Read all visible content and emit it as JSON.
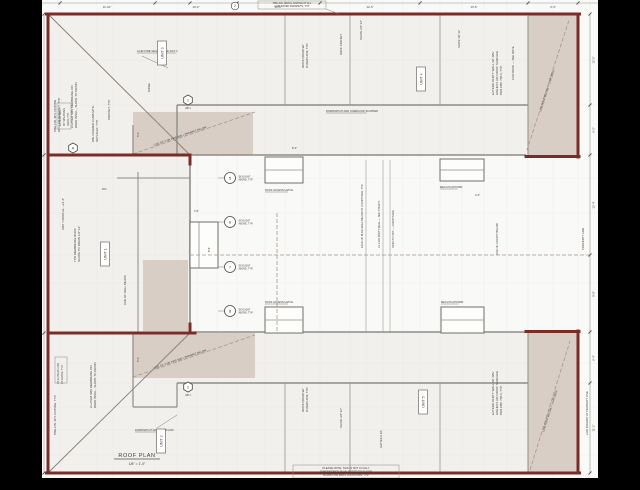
{
  "page": {
    "background": "#000000"
  },
  "colors": {
    "wall": "#7a2c27",
    "shade": "#d6cbc3",
    "paper": "#f9f9f7",
    "bar": "#f1f0ec",
    "line": "#8d8c88",
    "dash": "#a8968e",
    "ink": "#3e3d3a"
  },
  "title_block": {
    "title": "ROOF PLAN",
    "scale": "1/8\" = 1'-0\""
  },
  "notes": {
    "top_lines": [
      "PRE-FIN. METAL COPING AT ALL",
      "2-HR RATED PARAPETS, TYP."
    ],
    "bottom_lines": [
      "PLEASE NOTE: THIS IS NOT A FULLY",
      "DIMENSIONED PLAN. REFER TO FLOOR",
      "PLANS FOR WALL LOCATIONS, TYP."
    ]
  },
  "units": [
    {
      "label": "UNIT 3",
      "x": 120,
      "y": 53
    },
    {
      "label": "UNIT 4",
      "x": 379,
      "y": 79
    },
    {
      "label": "UNIT 1",
      "x": 63,
      "y": 254
    },
    {
      "label": "UNIT 2",
      "x": 119,
      "y": 441
    },
    {
      "label": "UNIT 5",
      "x": 381,
      "y": 402
    }
  ],
  "annotations": [
    {
      "x": 14,
      "y": 132,
      "r": -90,
      "t": "PRE-FIN. MTL COPING"
    },
    {
      "x": 18,
      "y": 132,
      "r": -90,
      "t": "ON 2-HR PARAPET, TYP."
    },
    {
      "x": 31,
      "y": 128,
      "r": -90,
      "t": "2-LAYER SBS MEMBRANE ON"
    },
    {
      "x": 35,
      "y": 128,
      "r": -90,
      "t": "RIGID INSUL., SLOPE TO DRAIN"
    },
    {
      "x": 52,
      "y": 142,
      "r": -90,
      "t": "DBL FRAMED CURB MTD."
    },
    {
      "x": 56,
      "y": 142,
      "r": -90,
      "t": "SKYLIGHT, TYP."
    },
    {
      "x": 68,
      "y": 120,
      "r": -90,
      "t": "CRICKET, TYP."
    },
    {
      "x": 95,
      "y": 52,
      "r": 0,
      "t": "2-HR FIRE WALL — SEE 4/A7.1",
      "s": 2.8,
      "ul": 1
    },
    {
      "x": 108,
      "y": 92,
      "r": -90,
      "t": "RIDGE",
      "s": 2.8
    },
    {
      "x": 19,
      "y": 126,
      "r": -90,
      "t": "EXTEND WALL",
      "s": 2.5
    },
    {
      "x": 23,
      "y": 126,
      "r": -90,
      "t": "30\" MIN ABOVE",
      "s": 2.5
    },
    {
      "x": 27,
      "y": 126,
      "r": -90,
      "t": "ROOF, TYP.",
      "s": 2.5
    },
    {
      "x": 262,
      "y": 68,
      "r": -90,
      "t": "ROOF DRAIN W/"
    },
    {
      "x": 266,
      "y": 68,
      "r": -90,
      "t": "OVERFLOW, TYP."
    },
    {
      "x": 300,
      "y": 55,
      "r": -90,
      "t": "ROOF CRICKET",
      "s": 2.8
    },
    {
      "x": 284,
      "y": 112,
      "r": 0,
      "t": "DOWNSPOUT AND OVERFLOW SCUPPER",
      "s": 2.6,
      "ul": 1
    },
    {
      "x": 320,
      "y": 40,
      "r": -90,
      "t": "SLOPE 1/4\":12\"",
      "s": 2.8
    },
    {
      "x": 452,
      "y": 95,
      "r": -90,
      "t": "EXTEND PARTY WALL 30\" ABV"
    },
    {
      "x": 456,
      "y": 95,
      "r": -90,
      "t": "HIGHEST ADJ ROOF SURFACE"
    },
    {
      "x": 460,
      "y": 95,
      "r": -90,
      "t": "PER CBC 706.6, TYP."
    },
    {
      "x": 472,
      "y": 80,
      "r": -90,
      "t": "LOW ROOF — SEE NOTE",
      "s": 2.8
    },
    {
      "x": 418,
      "y": 48,
      "r": -90,
      "t": "SLOPE 1/4\":12\"",
      "s": 2.6
    },
    {
      "x": 499,
      "y": 112,
      "r": -72,
      "t": "LOW ROOF BELOW — 2-HR DECK",
      "s": 2.7
    },
    {
      "x": 502,
      "y": 432,
      "r": -72,
      "t": "LOW ROOF BELOW — 2-HR DECK",
      "s": 2.7
    },
    {
      "x": 22,
      "y": 230,
      "r": -90,
      "t": "UNIT 1 ROOF EL. +21'-4\"",
      "s": 2.8
    },
    {
      "x": 34,
      "y": 262,
      "r": -90,
      "t": "TPO MEMBRANE ROOF"
    },
    {
      "x": 38,
      "y": 262,
      "r": -90,
      "t": "SLOPE TO DRAIN 1/4\":12\""
    },
    {
      "x": 84,
      "y": 305,
      "r": -90,
      "t": "LINE OF WALL BELOW",
      "s": 2.8
    },
    {
      "x": 17,
      "y": 384,
      "r": -90,
      "t": "DS & OVERFLOW",
      "s": 2.5
    },
    {
      "x": 21,
      "y": 384,
      "r": -90,
      "t": "AT GRADE, TYP.",
      "s": 2.5
    },
    {
      "x": 60,
      "y": 190,
      "r": 0,
      "t": "R.D.",
      "s": 2.5
    },
    {
      "x": 112,
      "y": 146,
      "r": -19,
      "t": "LINE OF 2-HR FIRE WALL PARAPET BELOW",
      "s": 2.7
    },
    {
      "x": 112,
      "y": 369,
      "r": -19,
      "t": "LINE OF 2-HR FIRE WALL PARAPET BELOW",
      "s": 2.7
    },
    {
      "x": 223,
      "y": 191,
      "r": 0,
      "t": "ROOF ACCESS HATCH",
      "s": 2.6,
      "ul": 1
    },
    {
      "x": 398,
      "y": 188,
      "r": 0,
      "t": "MECH PLATFORM",
      "s": 2.6,
      "ul": 1
    },
    {
      "x": 223,
      "y": 303,
      "r": 0,
      "t": "ROOF ACCESS HATCH",
      "s": 2.6,
      "ul": 1
    },
    {
      "x": 399,
      "y": 303,
      "r": 0,
      "t": "MECH PLATFORM",
      "s": 2.6,
      "ul": 1
    },
    {
      "x": 321,
      "y": 248,
      "r": -90,
      "t": "FACE OF BLDG WALL BELOW AT COURTYARD, TYP.",
      "s": 2.6
    },
    {
      "x": 338,
      "y": 248,
      "r": -90,
      "t": "CL 2-HR PARTY WALL — SEE STRUCT.",
      "s": 2.6
    },
    {
      "x": 352,
      "y": 248,
      "r": -90,
      "t": "OPEN TO SKY — COURTYARD",
      "s": 2.6
    },
    {
      "x": 152,
      "y": 212,
      "r": 0,
      "t": "3'-6\"",
      "s": 2.5
    },
    {
      "x": 456,
      "y": 255,
      "r": -90,
      "t": "LINE OF CANOPY BELOW",
      "s": 2.6
    },
    {
      "x": 50,
      "y": 408,
      "r": -90,
      "t": "2-LAYER SBS MEMBRANE ON"
    },
    {
      "x": 54,
      "y": 408,
      "r": -90,
      "t": "RIGID INSUL., SLOPE TO DRAIN"
    },
    {
      "x": 14,
      "y": 435,
      "r": -90,
      "t": "PRE-FIN. MTL COPING, TYP."
    },
    {
      "x": 93,
      "y": 431,
      "r": 0,
      "t": "DOWNSPOUT AND OVERFLOW",
      "s": 2.6,
      "ul": 1
    },
    {
      "x": 262,
      "y": 412,
      "r": -90,
      "t": "ROOF DRAIN W/"
    },
    {
      "x": 266,
      "y": 412,
      "r": -90,
      "t": "OVERFLOW, TYP."
    },
    {
      "x": 300,
      "y": 428,
      "r": -90,
      "t": "SLOPE 1/4\":12\"",
      "s": 2.8
    },
    {
      "x": 340,
      "y": 448,
      "r": -90,
      "t": "GUTTER & DS",
      "s": 2.6
    },
    {
      "x": 452,
      "y": 415,
      "r": -90,
      "t": "EXTEND PARTY WALL 30\" ABV"
    },
    {
      "x": 456,
      "y": 415,
      "r": -90,
      "t": "HIGHEST ADJ ROOF SURFACE"
    },
    {
      "x": 460,
      "y": 415,
      "r": -90,
      "t": "PER CBC 706.6, TYP."
    },
    {
      "x": 542,
      "y": 250,
      "r": -90,
      "t": "PROPERTY LINE",
      "s": 2.8
    },
    {
      "x": 546,
      "y": 435,
      "r": -90,
      "t": "2-HR PARAPET AT PROPERTY LINE",
      "s": 2.6
    },
    {
      "x": 97,
      "y": 137,
      "r": -90,
      "t": "5'-0\"",
      "s": 2.6
    },
    {
      "x": 97,
      "y": 362,
      "r": -90,
      "t": "5'-0\"",
      "s": 2.6
    },
    {
      "x": 168,
      "y": 252,
      "r": -90,
      "t": "8'-6\"",
      "s": 2.6
    },
    {
      "x": 250,
      "y": 149,
      "r": 0,
      "t": "8'-0\"",
      "s": 2.6
    },
    {
      "x": 433,
      "y": 196,
      "r": 0,
      "t": "4'-0\"",
      "s": 2.6
    }
  ],
  "markers": {
    "circles": [
      {
        "x": 188,
        "y": 178,
        "n": "5",
        "n1": "SKYLIGHT",
        "n2": "ABOVE, TYP."
      },
      {
        "x": 188,
        "y": 222,
        "n": "6",
        "n1": "SKYLIGHT",
        "n2": "ABOVE, TYP."
      },
      {
        "x": 188,
        "y": 267,
        "n": "7",
        "n1": "SKYLIGHT",
        "n2": "ABOVE, TYP."
      },
      {
        "x": 188,
        "y": 311,
        "n": "8",
        "n1": "SKYLIGHT",
        "n2": "ABOVE, TYP."
      }
    ],
    "hexagons": [
      {
        "x": 146,
        "y": 100,
        "label": "1",
        "sub": "W8.1"
      },
      {
        "x": 146,
        "y": 387,
        "label": "1",
        "sub": "W8.1"
      },
      {
        "x": 31,
        "y": 148,
        "label": "A",
        "sub": ""
      }
    ],
    "grid_bubbles": [
      {
        "x": 193,
        "y": 6,
        "label": "2"
      }
    ]
  },
  "dimensions": {
    "top": [
      {
        "x": 65,
        "t": "11'-10\""
      },
      {
        "x": 154,
        "t": "10'-2\""
      },
      {
        "x": 236,
        "t": "10'-4\""
      },
      {
        "x": 328,
        "t": "12'-6\""
      },
      {
        "x": 432,
        "t": "13'-6\""
      },
      {
        "x": 511,
        "t": "6'-3\""
      }
    ],
    "right": [
      {
        "y": 60,
        "t": "12'-6\""
      },
      {
        "y": 130,
        "t": "6'-2\""
      },
      {
        "y": 205,
        "t": "12'-4\""
      },
      {
        "y": 294,
        "t": "9'-8\""
      },
      {
        "y": 358,
        "t": "6'-4\""
      },
      {
        "y": 428,
        "t": "11'-2\""
      }
    ]
  }
}
